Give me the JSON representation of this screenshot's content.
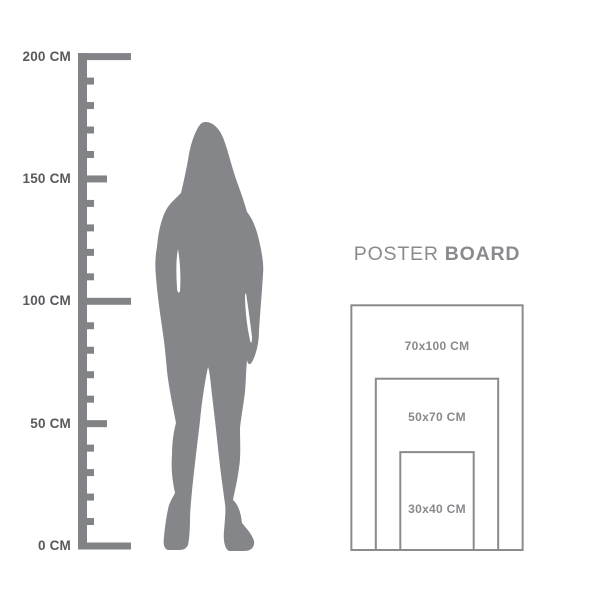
{
  "figure": {
    "px_per_cm": 2.447
  },
  "ruler": {
    "unit": "CM",
    "min_cm": 0,
    "max_cm": 200,
    "tick_step_cm": 10,
    "medium_step_cm": 50,
    "major_step_cm": 100,
    "labels": [
      {
        "value_cm": 200,
        "text": "200 CM"
      },
      {
        "value_cm": 150,
        "text": "150 CM"
      },
      {
        "value_cm": 100,
        "text": "100 CM"
      },
      {
        "value_cm": 50,
        "text": "50 CM"
      },
      {
        "value_cm": 0,
        "text": "0 CM"
      }
    ],
    "color": "#828387",
    "label_color": "#58595C"
  },
  "poster_board": {
    "title_regular": "POSTER",
    "title_bold": "BOARD",
    "title_color": "#8A8B8E",
    "border_color": "#8A8B8E",
    "label_color": "#88898C",
    "sizes": [
      {
        "label": "70x100 CM",
        "width_cm": 70,
        "height_cm": 100
      },
      {
        "label": "50x70 CM",
        "width_cm": 50,
        "height_cm": 70
      },
      {
        "label": "30x40 CM",
        "width_cm": 30,
        "height_cm": 40
      }
    ]
  },
  "colors": {
    "background": "#FFFFFF",
    "silhouette": "#85868A"
  }
}
